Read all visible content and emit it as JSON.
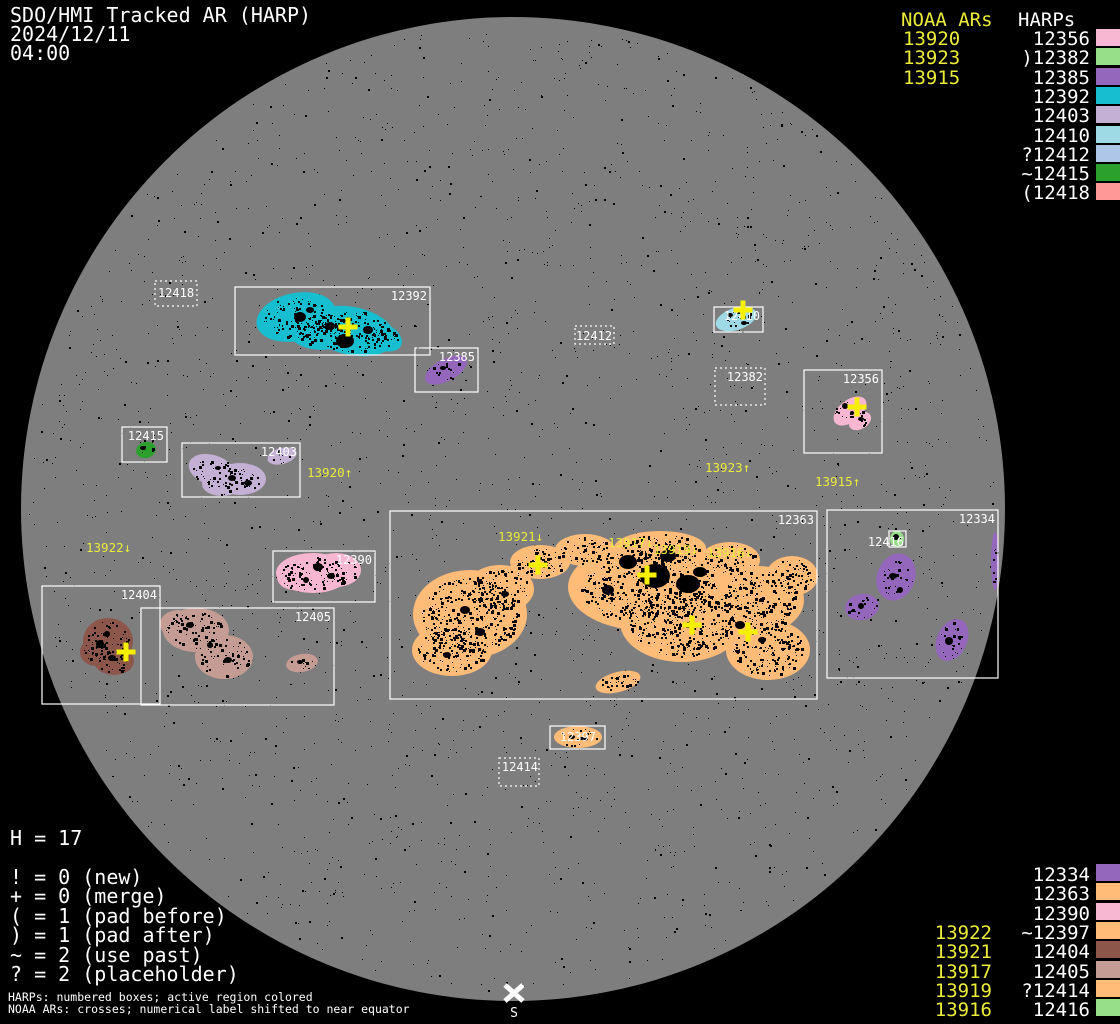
{
  "header": {
    "title": "SDO/HMI Tracked AR (HARP)",
    "date": "2024/12/11",
    "time": "04:00"
  },
  "colors": {
    "background": "#000000",
    "disk": "#7e7e7e",
    "white": "#ffffff",
    "yellow_text": "#ebeb3c",
    "yellow_cross": "#f5ef00",
    "box_stroke": "#ffffff",
    "speckle": "#000000"
  },
  "north_legend": {
    "noaa_header": "NOAA ARs",
    "harps_header": "HARPs",
    "noaa": [
      "13920",
      "13923",
      "13915"
    ],
    "harps": [
      {
        "prefix": "",
        "label": "12356",
        "color": "#f7b6d2"
      },
      {
        "prefix": ")",
        "label": "12382",
        "color": "#98df8a"
      },
      {
        "prefix": "",
        "label": "12385",
        "color": "#9467bd"
      },
      {
        "prefix": "",
        "label": "12392",
        "color": "#17becf"
      },
      {
        "prefix": "",
        "label": "12403",
        "color": "#c5b0d5"
      },
      {
        "prefix": "",
        "label": "12410",
        "color": "#9edae5"
      },
      {
        "prefix": "?",
        "label": "12412",
        "color": "#aec7e8"
      },
      {
        "prefix": "~",
        "label": "12415",
        "color": "#2ca02c"
      },
      {
        "prefix": "(",
        "label": "12418",
        "color": "#ff9896"
      }
    ]
  },
  "south_legend": {
    "rows": [
      {
        "prefix": "",
        "label": "12334",
        "noaa": "",
        "color": "#9467bd"
      },
      {
        "prefix": "",
        "label": "12363",
        "noaa": "",
        "color": "#ffbb78"
      },
      {
        "prefix": "",
        "label": "12390",
        "noaa": "",
        "color": "#f7b6d2"
      },
      {
        "prefix": "~",
        "label": "12397",
        "noaa": "13922",
        "color": "#ffbb78"
      },
      {
        "prefix": "",
        "label": "12404",
        "noaa": "13921",
        "color": "#8c564b"
      },
      {
        "prefix": "",
        "label": "12405",
        "noaa": "13917",
        "color": "#c49c94"
      },
      {
        "prefix": "?",
        "label": "12414",
        "noaa": "13919",
        "color": "#ffbb78"
      },
      {
        "prefix": "",
        "label": "12416",
        "noaa": "13916",
        "color": "#98df8a"
      }
    ]
  },
  "stats": {
    "h_count": "H = 17"
  },
  "flags": [
    "! = 0 (new)",
    "+ = 0 (merge)",
    "( = 1 (pad before)",
    ") = 1 (pad after)",
    "~ = 2 (use past)",
    "? = 2 (placeholder)"
  ],
  "footer": [
    "HARPs: numbered boxes; active region colored",
    "NOAA ARs: crosses; numerical label shifted to near equator"
  ],
  "south_marker": {
    "label": "S",
    "x": 514,
    "y": 993,
    "label_y": 1017
  },
  "chart_data": {
    "type": "scatter",
    "subtype": "solar-disk-harp-tracking-map",
    "title": "SDO/HMI Tracked AR (HARP)",
    "datetime": "2024/12/11 04:00",
    "disk": {
      "cx": 513,
      "cy": 509,
      "r": 492
    },
    "harp_regions": [
      {
        "harp": "12418",
        "box": [
          155,
          281,
          42,
          25
        ],
        "style": "dotted",
        "color": "#ff9896",
        "label": {
          "x": 176,
          "y": 297,
          "anchor": "middle"
        },
        "blobs": [],
        "spots": [],
        "density": 0
      },
      {
        "harp": "12392",
        "box": [
          235,
          287,
          195,
          68
        ],
        "style": "solid",
        "color": "#17becf",
        "label": {
          "x": 427,
          "y": 300,
          "anchor": "end"
        },
        "blobs": [
          [
            296,
            317,
            40,
            24,
            -12
          ],
          [
            352,
            331,
            44,
            24,
            12
          ],
          [
            322,
            330,
            34,
            20,
            0
          ],
          [
            383,
            337,
            20,
            13,
            25
          ]
        ],
        "spots": [
          [
            345,
            341,
            9,
            7
          ],
          [
            300,
            317,
            6,
            5
          ],
          [
            330,
            326,
            5,
            4
          ],
          [
            368,
            330,
            5,
            4
          ],
          [
            310,
            310,
            4,
            3
          ]
        ],
        "density": 1.5
      },
      {
        "harp": "12385",
        "box": [
          415,
          348,
          63,
          44
        ],
        "style": "solid",
        "color": "#9467bd",
        "label": {
          "x": 475,
          "y": 361,
          "anchor": "end"
        },
        "blobs": [
          [
            446,
            370,
            23,
            11,
            -28
          ]
        ],
        "spots": [
          [
            443,
            368,
            3,
            2
          ]
        ],
        "density": 0.9
      },
      {
        "harp": "12412",
        "box": [
          575,
          326,
          39,
          18
        ],
        "style": "dotted",
        "color": "#aec7e8",
        "label": {
          "x": 594,
          "y": 340,
          "anchor": "middle"
        },
        "blobs": [],
        "spots": [],
        "density": 0
      },
      {
        "harp": "12410",
        "box": [
          714,
          307,
          49,
          25
        ],
        "style": "solid",
        "color": "#9edae5",
        "label": {
          "x": 760,
          "y": 320,
          "anchor": "end"
        },
        "blobs": [
          [
            736,
            319,
            21,
            11,
            -18
          ]
        ],
        "spots": [
          [
            730,
            315,
            3,
            2
          ],
          [
            744,
            323,
            3,
            2
          ]
        ],
        "density": 1.0
      },
      {
        "harp": "12382",
        "box": [
          715,
          368,
          50,
          37
        ],
        "style": "dotted",
        "color": "#98df8a",
        "label": {
          "x": 763,
          "y": 381,
          "anchor": "end"
        },
        "blobs": [],
        "spots": [],
        "density": 0
      },
      {
        "harp": "12356",
        "box": [
          804,
          370,
          78,
          83
        ],
        "style": "solid",
        "color": "#f7b6d2",
        "label": {
          "x": 879,
          "y": 383,
          "anchor": "end"
        },
        "blobs": [
          [
            850,
            411,
            19,
            11,
            -38
          ],
          [
            860,
            421,
            12,
            8,
            -30
          ]
        ],
        "spots": [
          [
            845,
            406,
            3,
            3
          ],
          [
            861,
            419,
            3,
            2
          ],
          [
            852,
            413,
            2,
            2
          ]
        ],
        "density": 1.0
      },
      {
        "harp": "12415",
        "box": [
          122,
          427,
          45,
          35
        ],
        "style": "solid",
        "color": "#2ca02c",
        "label": {
          "x": 164,
          "y": 440,
          "anchor": "end"
        },
        "blobs": [
          [
            146,
            450,
            10,
            8,
            -15
          ]
        ],
        "spots": [
          [
            143,
            448,
            3,
            2
          ]
        ],
        "density": 1.2
      },
      {
        "harp": "12403",
        "box": [
          182,
          443,
          118,
          54
        ],
        "style": "solid",
        "color": "#c5b0d5",
        "label": {
          "x": 297,
          "y": 456,
          "anchor": "end"
        },
        "blobs": [
          [
            212,
            470,
            24,
            15,
            18
          ],
          [
            240,
            479,
            26,
            16,
            0
          ],
          [
            222,
            484,
            20,
            12,
            0
          ],
          [
            282,
            456,
            15,
            8,
            -15
          ]
        ],
        "spots": [
          [
            232,
            478,
            4,
            3
          ],
          [
            248,
            483,
            4,
            3
          ],
          [
            218,
            468,
            3,
            2
          ]
        ],
        "density": 1.1
      },
      {
        "harp": "12390",
        "box": [
          273,
          551,
          102,
          51
        ],
        "style": "solid",
        "color": "#f7b6d2",
        "label": {
          "x": 372,
          "y": 564,
          "anchor": "end"
        },
        "blobs": [
          [
            313,
            573,
            37,
            20,
            0
          ],
          [
            336,
            570,
            25,
            17,
            0
          ],
          [
            294,
            577,
            17,
            13,
            0
          ]
        ],
        "spots": [
          [
            318,
            567,
            5,
            4
          ],
          [
            331,
            576,
            4,
            3
          ],
          [
            306,
            580,
            3,
            3
          ]
        ],
        "density": 1.1
      },
      {
        "harp": "12404",
        "box": [
          42,
          586,
          118,
          118
        ],
        "style": "solid",
        "color": "#8c564b",
        "label": {
          "x": 157,
          "y": 599,
          "anchor": "end"
        },
        "blobs": [
          [
            108,
            641,
            25,
            23,
            0
          ],
          [
            114,
            661,
            20,
            14,
            0
          ],
          [
            96,
            652,
            16,
            14,
            0
          ]
        ],
        "spots": [
          [
            100,
            644,
            4,
            4
          ],
          [
            112,
            658,
            4,
            3
          ],
          [
            107,
            634,
            3,
            3
          ]
        ],
        "density": 1.3
      },
      {
        "harp": "12405",
        "box": [
          141,
          608,
          193,
          97
        ],
        "style": "solid",
        "color": "#c49c94",
        "label": {
          "x": 331,
          "y": 621,
          "anchor": "end"
        },
        "blobs": [
          [
            196,
            630,
            33,
            22,
            0
          ],
          [
            224,
            657,
            29,
            22,
            0
          ],
          [
            178,
            624,
            18,
            14,
            0
          ],
          [
            302,
            663,
            16,
            9,
            -10
          ]
        ],
        "spots": [
          [
            190,
            625,
            4,
            3
          ],
          [
            228,
            660,
            4,
            3
          ],
          [
            210,
            645,
            3,
            3
          ],
          [
            300,
            662,
            3,
            2
          ]
        ],
        "density": 1.1
      },
      {
        "harp": "12363",
        "box": [
          390,
          511,
          427,
          188
        ],
        "style": "solid",
        "color": "#ffbb78",
        "label": {
          "x": 814,
          "y": 524,
          "anchor": "end"
        },
        "blobs": [
          [
            470,
            614,
            57,
            44,
            0
          ],
          [
            500,
            589,
            34,
            24,
            0
          ],
          [
            452,
            650,
            40,
            26,
            0
          ],
          [
            540,
            562,
            30,
            17,
            0
          ],
          [
            585,
            550,
            30,
            16,
            0
          ],
          [
            648,
            587,
            80,
            44,
            0
          ],
          [
            682,
            622,
            62,
            40,
            0
          ],
          [
            660,
            548,
            46,
            17,
            0
          ],
          [
            758,
            600,
            46,
            34,
            0
          ],
          [
            768,
            650,
            42,
            30,
            0
          ],
          [
            792,
            576,
            26,
            20,
            0
          ],
          [
            730,
            560,
            30,
            18,
            0
          ],
          [
            618,
            682,
            23,
            10,
            -15
          ]
        ],
        "spots": [
          [
            655,
            576,
            15,
            12
          ],
          [
            688,
            584,
            12,
            9
          ],
          [
            628,
            562,
            9,
            7
          ],
          [
            668,
            556,
            8,
            6
          ],
          [
            700,
            572,
            7,
            5
          ],
          [
            608,
            590,
            6,
            5
          ],
          [
            465,
            610,
            5,
            4
          ],
          [
            480,
            632,
            5,
            4
          ],
          [
            447,
            655,
            4,
            3
          ],
          [
            505,
            594,
            4,
            3
          ],
          [
            740,
            625,
            5,
            4
          ],
          [
            762,
            640,
            4,
            3
          ]
        ],
        "density": 1.7
      },
      {
        "harp": "12334",
        "box": [
          827,
          510,
          171,
          168
        ],
        "style": "solid",
        "color": "#9467bd",
        "label": {
          "x": 995,
          "y": 523,
          "anchor": "end"
        },
        "blobs": [
          [
            896,
            577,
            19,
            24,
            20
          ],
          [
            862,
            607,
            17,
            13,
            -10
          ],
          [
            952,
            640,
            15,
            22,
            25
          ],
          [
            995,
            561,
            4,
            29,
            0
          ]
        ],
        "spots": [
          [
            893,
            576,
            4,
            3
          ],
          [
            949,
            641,
            4,
            4
          ],
          [
            861,
            606,
            3,
            3
          ],
          [
            900,
            590,
            3,
            3
          ]
        ],
        "density": 1.0
      },
      {
        "harp": "12416",
        "box": [
          889,
          531,
          17,
          16
        ],
        "style": "solid",
        "color": "#98df8a",
        "label": {
          "x": 904,
          "y": 546,
          "anchor": "end"
        },
        "blobs": [
          [
            897,
            539,
            7,
            8,
            0
          ]
        ],
        "spots": [
          [
            896,
            537,
            3,
            3
          ]
        ],
        "density": 0.5
      },
      {
        "harp": "12397",
        "box": [
          550,
          726,
          55,
          23
        ],
        "style": "solid",
        "color": "#ffbb78",
        "label": {
          "x": 596,
          "y": 741,
          "anchor": "end"
        },
        "blobs": [
          [
            578,
            737,
            24,
            11,
            0
          ]
        ],
        "spots": [
          [
            572,
            737,
            3,
            2
          ],
          [
            585,
            739,
            3,
            2
          ]
        ],
        "density": 0.8
      },
      {
        "harp": "12414",
        "box": [
          499,
          758,
          40,
          28
        ],
        "style": "dotted",
        "color": "#ffbb78",
        "label": {
          "x": 538,
          "y": 771,
          "anchor": "end"
        },
        "blobs": [],
        "spots": [],
        "density": 0
      }
    ],
    "noaa_crosses": [
      {
        "noaa": "13920",
        "x": 348,
        "y": 327
      },
      {
        "noaa": "13923",
        "x": 743,
        "y": 310
      },
      {
        "noaa": "13915",
        "x": 857,
        "y": 407
      },
      {
        "noaa": "13922",
        "x": 126,
        "y": 652
      },
      {
        "noaa": "13921",
        "x": 538,
        "y": 565
      },
      {
        "noaa": "13917",
        "x": 647,
        "y": 575
      },
      {
        "noaa": "13919",
        "x": 692,
        "y": 625
      },
      {
        "noaa": "13916",
        "x": 748,
        "y": 632
      }
    ],
    "noaa_labels": [
      {
        "text": "13920↑",
        "x": 307,
        "y": 477
      },
      {
        "text": "13922↓",
        "x": 86,
        "y": 552
      },
      {
        "text": "13923↑",
        "x": 705,
        "y": 472
      },
      {
        "text": "13915↑",
        "x": 815,
        "y": 486
      },
      {
        "text": "13921↓",
        "x": 498,
        "y": 541
      },
      {
        "text": "13917↓",
        "x": 608,
        "y": 547
      },
      {
        "text": "13919↓",
        "x": 653,
        "y": 554
      },
      {
        "text": "13916↓",
        "x": 707,
        "y": 557
      }
    ]
  }
}
